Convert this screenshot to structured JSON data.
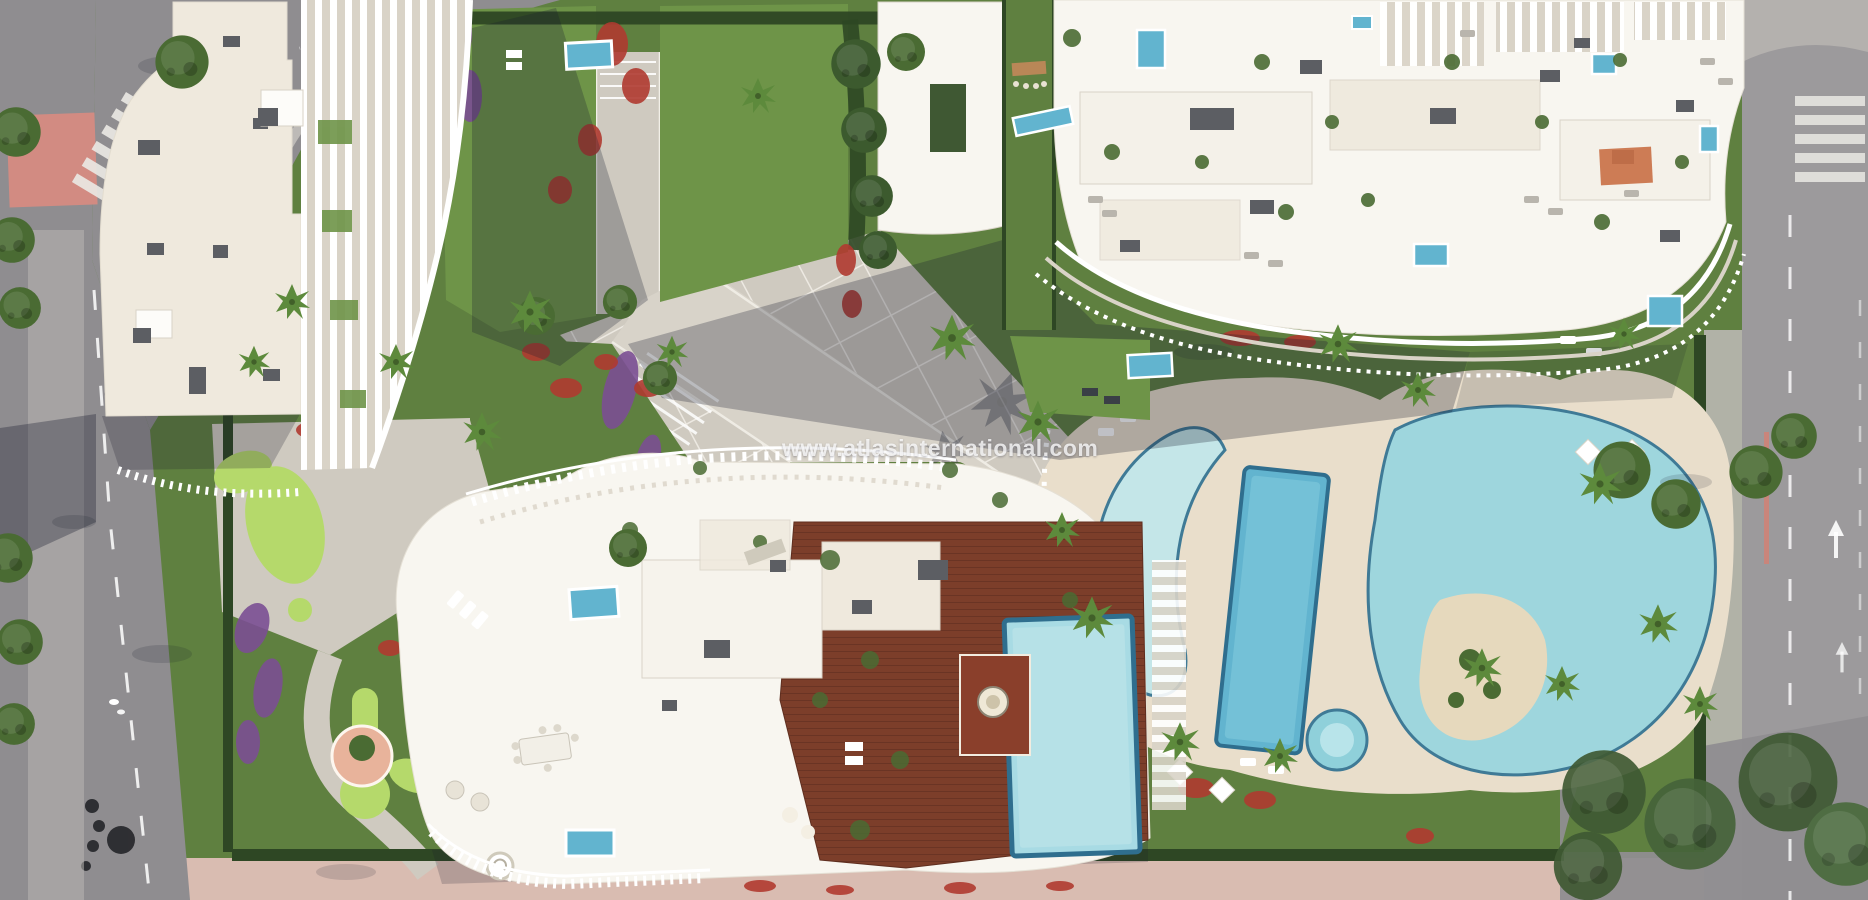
{
  "watermark": {
    "text": "www.atlasinternational.com"
  },
  "palette": {
    "road": "#8f8d90",
    "road2": "#9c9a9c",
    "sidewalk": "#bab7b3",
    "pink": "#d9bcb1",
    "redpave": "#d28b82",
    "lawn": "#5f8040",
    "lawn2": "#6e9448",
    "lawndark": "#47652f",
    "golf": "#b5d96b",
    "hedge": "#3c5a2e",
    "hedgedark": "#2e4724",
    "tree": "#4a6b33",
    "palm": "#5d8a3c",
    "red": "#b03a30",
    "purple": "#7b4f93",
    "cream": "#efe9dd",
    "white": "#f8f6f0",
    "shade": "#d9d3c7",
    "box": "#5c5e63",
    "wood": "#7c3e2a",
    "wooddark": "#5f2e1f",
    "deckcream": "#e9decb",
    "pool": "#62b4cf",
    "poolpale": "#a8dbe4",
    "lagoon": "#9ed6dd",
    "poolrim": "#3f7a96",
    "sand": "#e6d9bd",
    "gravel": "#cfcac0",
    "gravel2": "#d8d3c9",
    "gridline": "#f2efe8",
    "peach": "#e8b39b",
    "rug": "#c96f45",
    "tan": "#b98757",
    "shadow": "rgba(24,28,45,0.33)",
    "watermark": "rgba(255,255,255,0.78)"
  }
}
